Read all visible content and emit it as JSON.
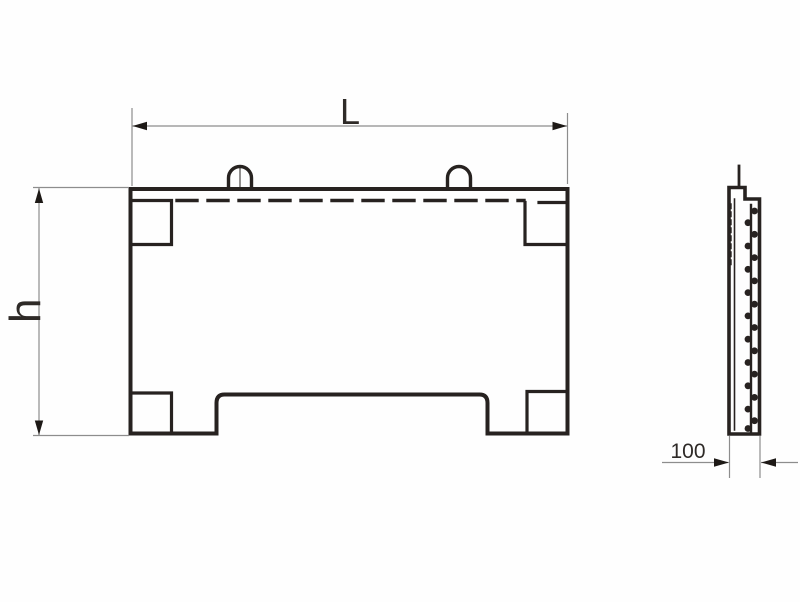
{
  "drawing": {
    "labels": {
      "length": "L",
      "height": "h",
      "thickness": "100"
    },
    "colors": {
      "background": "#fefefe",
      "line": "#272220",
      "thin_line": "#8d8d8d",
      "arrow": "#1d1916",
      "text": "#2e2a27"
    }
  }
}
